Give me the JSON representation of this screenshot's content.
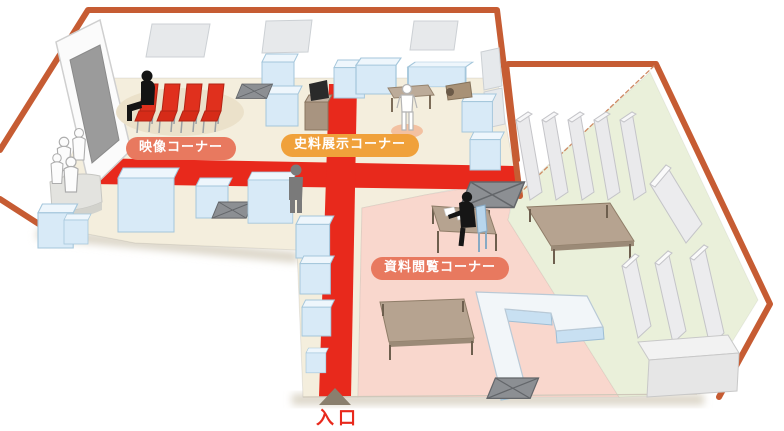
{
  "labels": {
    "video_corner": "映像コーナー",
    "exhibit_corner": "史料展示コーナー",
    "reading_corner": "資料閲覧コーナー",
    "entrance": "入口"
  },
  "colors": {
    "wall_outline": "#c65c33",
    "carpet_red": "#e8291c",
    "floor_beige": "#f4eedd",
    "floor_pink": "#f9d7cd",
    "floor_green": "#eaf0da",
    "display_case_blue": "#d8eaf7",
    "label_red_bg": "#e8795f",
    "label_orange_bg": "#f0a13b",
    "furniture_brown": "#b6a390",
    "entrance_text": "#e8291c"
  }
}
